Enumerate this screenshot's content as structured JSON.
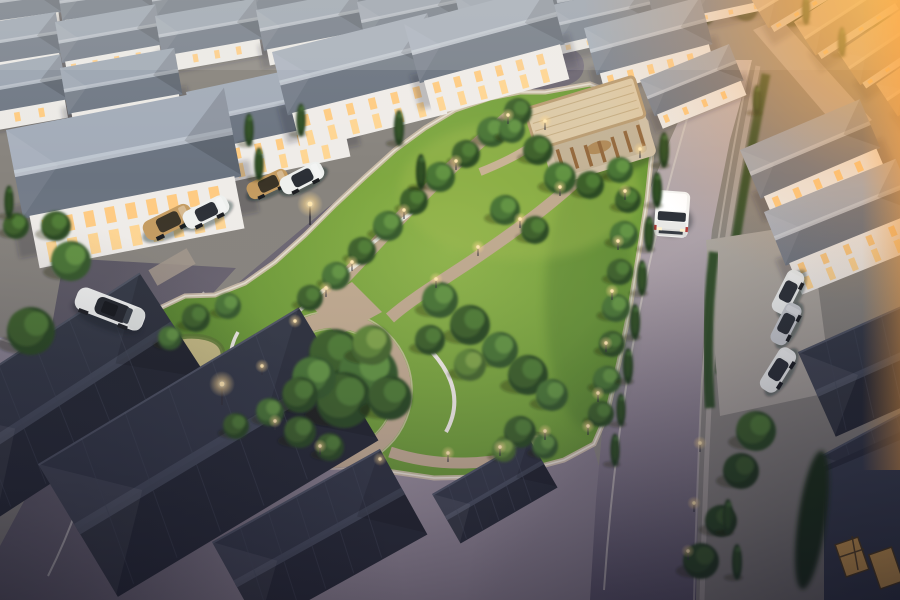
{
  "scene": {
    "title": "Aerial dusk rendering of a gated residential estate with a central landscaped park",
    "time_of_day": "golden hour / dusk, sun glow from upper right",
    "camera": "high oblique aerial view",
    "landmarks": {
      "central_park": "triangular park with lawn, circular walking loop, winding paver paths, white curved garden walls, ornamental grass beds and path lights",
      "pavilion": "open timber-column pavilion with flat slatted roof at the park's north-east corner",
      "housing": "rows of two-storey white houses with slate hip roofs and warm lit windows; tan sunlit rowhouse roofs at upper right; dark foreground roofs at bottom",
      "roads": "asphalt loop road around the park, long straight road on the right, curved road with white lane lines at lower left"
    },
    "vehicles": [
      {
        "name": "white-sedan",
        "description": "white sedan driving on the left road"
      },
      {
        "name": "white-minivan",
        "description": "white minivan driving toward camera on the right road"
      },
      {
        "name": "parked-cars",
        "description": "gold and white cars in left carports; white and silver cars parked by the right-hand houses"
      }
    ],
    "palette": {
      "roof_slate_light": "#9aa4b1",
      "roof_slate_dark": "#6e7784",
      "roof_warm_tan": "#c3ae94",
      "roof_foreground_dark": "#31353f",
      "wall_white": "#eceae6",
      "window_glow": "#ffc878",
      "lawn_bright": "#8fb44a",
      "lawn_deep": "#4f7c2a",
      "tree_green": "#3c612c",
      "path_tan": "#bfa98e",
      "road_dark": "#5c5864",
      "road_light": "#a79ca4",
      "sunset_orange": "#ffa83c",
      "wheat_grass": "#c6bb82",
      "pavilion_wood": "#9a6f42",
      "pavilion_roof": "#dcc9a6"
    }
  },
  "render": {
    "house_types": {
      "0": {
        "top": "#98a1ae",
        "front": "#727b88",
        "ridge": "#b7bec8",
        "wall": "#e7e5e1"
      },
      "1": {
        "top": "#9aa4b1",
        "front": "#6e7784",
        "ridge": "#bcc3cd",
        "wall": "#eceae6"
      },
      "2": {
        "top": "#a2abb8",
        "front": "#6a7380",
        "ridge": "#c2c9d2",
        "wall": "#efece8"
      },
      "3": {
        "top": "#c6b197",
        "front": "#9d8a74",
        "ridge": "#dcc9ab",
        "wall": "#d9cfc2"
      },
      "4": {
        "top": "#343945",
        "front": "#262a33",
        "ridge": "#4a505e",
        "wall": "#3a3f4a"
      }
    },
    "houses": [
      [
        -35,
        -12,
        92,
        -8,
        0
      ],
      [
        57,
        -16,
        92,
        -8,
        0
      ],
      [
        149,
        -18,
        92,
        -9,
        0
      ],
      [
        241,
        -20,
        92,
        -9,
        0
      ],
      [
        333,
        -18,
        90,
        -9,
        0
      ],
      [
        423,
        -14,
        90,
        -10,
        0
      ],
      [
        513,
        -8,
        90,
        -11,
        0
      ],
      [
        600,
        -14,
        92,
        -12,
        0
      ],
      [
        688,
        -20,
        90,
        -12,
        0
      ],
      [
        -45,
        28,
        102,
        -9,
        1
      ],
      [
        55,
        22,
        102,
        -10,
        1
      ],
      [
        155,
        16,
        102,
        -10,
        1
      ],
      [
        256,
        10,
        102,
        -11,
        1
      ],
      [
        357,
        2,
        100,
        -12,
        0
      ],
      [
        455,
        -4,
        98,
        -13,
        0
      ],
      [
        548,
        6,
        100,
        -13,
        0
      ],
      [
        -52,
        74,
        114,
        -10,
        1
      ],
      [
        60,
        68,
        116,
        -10,
        1
      ],
      [
        186,
        92,
        152,
        -12,
        2
      ],
      [
        272,
        52,
        160,
        -14,
        2
      ],
      [
        404,
        24,
        150,
        -15,
        2
      ],
      [
        584,
        28,
        120,
        -15,
        1
      ],
      [
        640,
        80,
        96,
        -22,
        1
      ],
      [
        6,
        130,
        222,
        -11,
        2
      ],
      [
        748,
        -6,
        98,
        -31,
        3
      ],
      [
        794,
        22,
        98,
        -33,
        3
      ],
      [
        838,
        52,
        98,
        -34,
        3
      ],
      [
        876,
        84,
        96,
        -34,
        3
      ],
      [
        900,
        118,
        94,
        -34,
        3
      ],
      [
        740,
        150,
        130,
        -23,
        1
      ],
      [
        764,
        212,
        142,
        -22,
        2
      ],
      [
        798,
        352,
        182,
        -24,
        4
      ],
      [
        820,
        456,
        172,
        -28,
        4
      ],
      [
        -72,
        410,
        252,
        -33,
        4
      ],
      [
        38,
        464,
        304,
        -31,
        4
      ],
      [
        212,
        542,
        192,
        -29,
        4
      ],
      [
        432,
        494,
        112,
        -30,
        4
      ]
    ],
    "tree_shades": [
      [
        "#22371c",
        "#2c4722",
        "#3a5c2a"
      ],
      [
        "#2c4a22",
        "#3c612c",
        "#4f7c36"
      ],
      [
        "#35582a",
        "#4a7434",
        "#629342"
      ],
      [
        "#46682e",
        "#5f8639",
        "#7fa348"
      ]
    ],
    "bg_trees": [
      [
        196,
        10,
        16,
        0
      ],
      [
        231,
        14,
        14,
        0
      ],
      [
        266,
        8,
        13,
        0
      ],
      [
        416,
        8,
        15,
        0
      ],
      [
        448,
        12,
        13,
        0
      ],
      [
        481,
        9,
        12,
        0
      ],
      [
        561,
        6,
        13,
        0
      ],
      [
        606,
        2,
        12,
        0
      ],
      [
        631,
        11,
        14,
        0
      ],
      [
        666,
        7,
        12,
        0
      ],
      [
        701,
        13,
        14,
        0
      ],
      [
        746,
        9,
        12,
        0
      ],
      [
        791,
        14,
        13,
        0
      ],
      [
        826,
        8,
        15,
        0
      ],
      [
        861,
        18,
        14,
        0
      ],
      [
        886,
        28,
        13,
        0
      ]
    ],
    "trees": [
      [
        518,
        112,
        14,
        1
      ],
      [
        492,
        132,
        15,
        2
      ],
      [
        466,
        154,
        14,
        1
      ],
      [
        440,
        177,
        15,
        2
      ],
      [
        414,
        201,
        14,
        1
      ],
      [
        388,
        226,
        15,
        2
      ],
      [
        362,
        251,
        14,
        1
      ],
      [
        336,
        276,
        14,
        2
      ],
      [
        310,
        298,
        13,
        1
      ],
      [
        628,
        200,
        13,
        1
      ],
      [
        624,
        235,
        14,
        2
      ],
      [
        620,
        272,
        13,
        1
      ],
      [
        616,
        308,
        14,
        2
      ],
      [
        612,
        344,
        13,
        1
      ],
      [
        607,
        380,
        14,
        2
      ],
      [
        601,
        414,
        13,
        1
      ],
      [
        335,
        355,
        26,
        1
      ],
      [
        368,
        375,
        30,
        2
      ],
      [
        344,
        400,
        28,
        1
      ],
      [
        314,
        378,
        22,
        2
      ],
      [
        372,
        345,
        20,
        3
      ],
      [
        390,
        398,
        22,
        1
      ],
      [
        300,
        395,
        18,
        1
      ],
      [
        440,
        300,
        18,
        2
      ],
      [
        470,
        325,
        20,
        1
      ],
      [
        500,
        350,
        18,
        2
      ],
      [
        528,
        375,
        20,
        1
      ],
      [
        552,
        395,
        16,
        2
      ],
      [
        470,
        365,
        16,
        3
      ],
      [
        430,
        340,
        15,
        1
      ],
      [
        505,
        210,
        15,
        2
      ],
      [
        535,
        230,
        14,
        1
      ],
      [
        300,
        432,
        16,
        1
      ],
      [
        270,
        412,
        14,
        2
      ],
      [
        330,
        447,
        14,
        1
      ],
      [
        196,
        318,
        14,
        1
      ],
      [
        170,
        338,
        12,
        2
      ],
      [
        228,
        306,
        13,
        2
      ],
      [
        520,
        432,
        16,
        1
      ],
      [
        545,
        446,
        13,
        2
      ],
      [
        504,
        450,
        12,
        3
      ],
      [
        538,
        150,
        15,
        1
      ],
      [
        560,
        178,
        16,
        2
      ],
      [
        590,
        185,
        14,
        1
      ],
      [
        620,
        170,
        13,
        2
      ],
      [
        512,
        130,
        13,
        2
      ],
      [
        31,
        331,
        24,
        1
      ],
      [
        71,
        261,
        20,
        2
      ],
      [
        16,
        226,
        13,
        1
      ],
      [
        56,
        226,
        15,
        1
      ],
      [
        236,
        426,
        13,
        1
      ],
      [
        756,
        431,
        20,
        1
      ],
      [
        741,
        471,
        18,
        0
      ],
      [
        721,
        521,
        16,
        0
      ],
      [
        701,
        561,
        18,
        0
      ]
    ],
    "cypress": [
      [
        664,
        150,
        12
      ],
      [
        657,
        190,
        12
      ],
      [
        649,
        234,
        12
      ],
      [
        642,
        278,
        12
      ],
      [
        635,
        322,
        12
      ],
      [
        628,
        366,
        12
      ],
      [
        621,
        410,
        11
      ],
      [
        615,
        450,
        11
      ],
      [
        399,
        128,
        12
      ],
      [
        421,
        172,
        12
      ],
      [
        301,
        120,
        11
      ],
      [
        259,
        164,
        11
      ],
      [
        9,
        202,
        11
      ],
      [
        249,
        130,
        11
      ],
      [
        757,
        100,
        10
      ],
      [
        806,
        10,
        10
      ],
      [
        842,
        42,
        10
      ],
      [
        728,
        517,
        12
      ],
      [
        737,
        562,
        12
      ]
    ],
    "lights": [
      [
        508,
        124,
        0
      ],
      [
        456,
        170,
        0
      ],
      [
        404,
        219,
        0
      ],
      [
        352,
        271,
        0
      ],
      [
        326,
        297,
        0
      ],
      [
        560,
        196,
        0
      ],
      [
        520,
        228,
        0
      ],
      [
        478,
        256,
        0
      ],
      [
        436,
        288,
        0
      ],
      [
        262,
        375,
        0
      ],
      [
        275,
        430,
        0
      ],
      [
        320,
        455,
        0
      ],
      [
        380,
        468,
        0
      ],
      [
        295,
        330,
        0
      ],
      [
        448,
        462,
        0
      ],
      [
        500,
        456,
        0
      ],
      [
        545,
        440,
        0
      ],
      [
        612,
        300,
        0
      ],
      [
        606,
        352,
        0
      ],
      [
        598,
        402,
        0
      ],
      [
        588,
        435,
        0
      ],
      [
        545,
        130,
        0
      ],
      [
        640,
        158,
        0
      ],
      [
        625,
        200,
        0
      ],
      [
        618,
        250,
        0
      ],
      [
        700,
        452,
        0
      ],
      [
        694,
        512,
        0
      ],
      [
        688,
        560,
        0
      ],
      [
        310,
        225,
        1
      ],
      [
        222,
        405,
        1
      ]
    ],
    "car_colors": {
      "gold": {
        "body": "#c49b60",
        "glass": "#3a3326"
      },
      "white": {
        "body": "#eef0ee",
        "glass": "#2b2f36"
      },
      "silver": {
        "body": "#c9ccd0",
        "glass": "#2b2f36"
      }
    },
    "cars": [
      [
        168,
        222,
        52,
        -26,
        "gold"
      ],
      [
        206,
        212,
        48,
        -26,
        "white"
      ],
      [
        268,
        184,
        44,
        -25,
        "gold"
      ],
      [
        302,
        178,
        46,
        -27,
        "white"
      ],
      [
        788,
        292,
        46,
        -63,
        "white"
      ],
      [
        786,
        324,
        44,
        -63,
        "silver"
      ],
      [
        778,
        370,
        48,
        -58,
        "white"
      ]
    ]
  }
}
